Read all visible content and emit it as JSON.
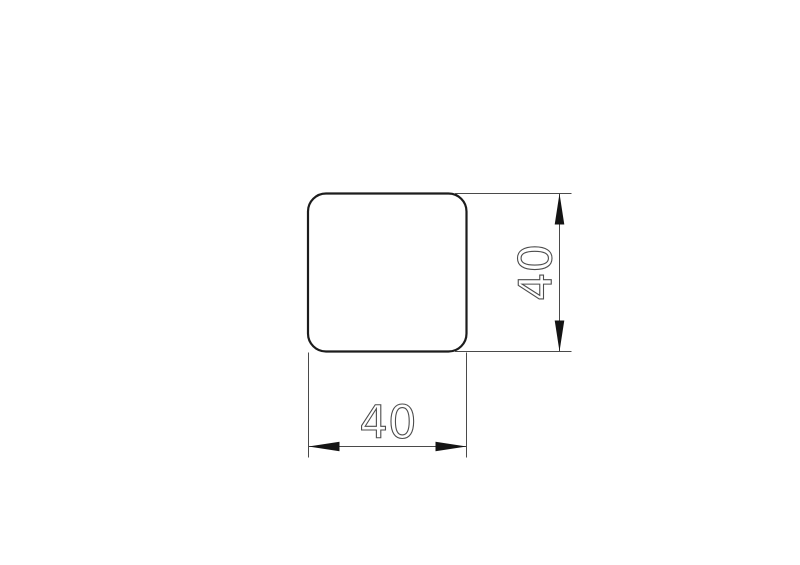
{
  "colors": {
    "background": "#ffffff",
    "outline": "#1c1c1c",
    "dimension_line": "#4a4a4a",
    "arrow_fill": "#141414",
    "text_outline": "#4d4d4d"
  },
  "profile": {
    "shape": "rounded-square"
  },
  "dimensions": {
    "width": {
      "label": "40"
    },
    "height": {
      "label": "40"
    }
  }
}
